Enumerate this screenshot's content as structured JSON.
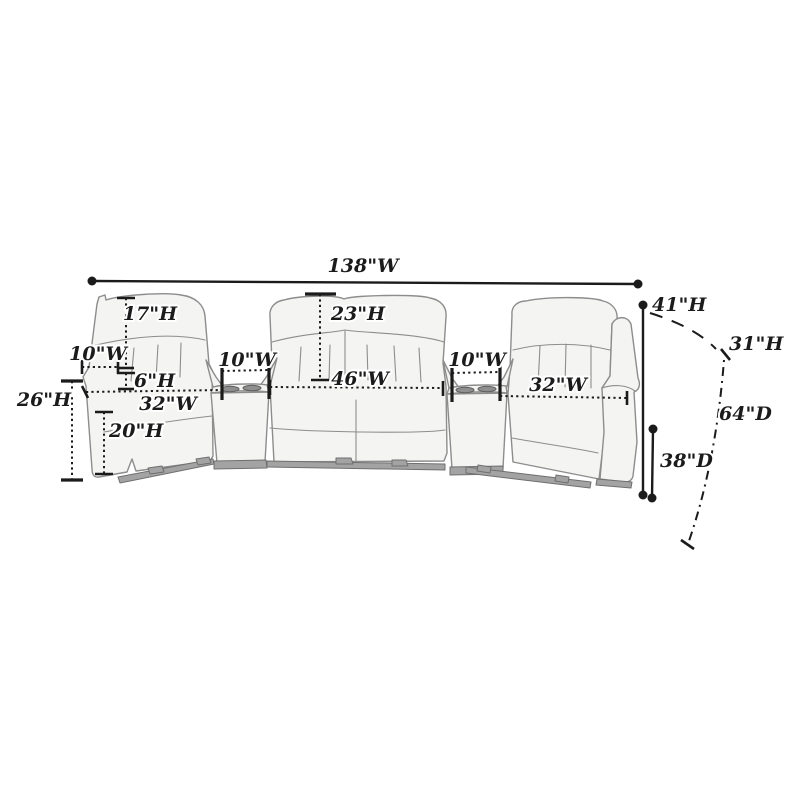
{
  "labels": {
    "overall_width": "138\"W",
    "back_cushion_height": "17\"H",
    "left_arm_width": "10\"W",
    "arm_to_seat_height": "6\"H",
    "arm_height": "26\"H",
    "left_seat_width": "32\"W",
    "seat_height": "20\"H",
    "left_console_width": "10\"W",
    "center_back_height": "23\"H",
    "center_section_width": "46\"W",
    "right_console_width": "10\"W",
    "right_seat_width": "32\"W",
    "overall_height": "41\"H",
    "reclined_back_height": "31\"H",
    "reclined_depth": "64\"D",
    "upright_depth": "38\"D"
  },
  "style": {
    "ink": "#1b1b1b",
    "sofa_fill": "#f4f4f2",
    "sofa_line": "#8d8d8d",
    "rail_fill": "#a3a3a3",
    "rail_line": "#6f6f6f",
    "background": "#ffffff"
  }
}
